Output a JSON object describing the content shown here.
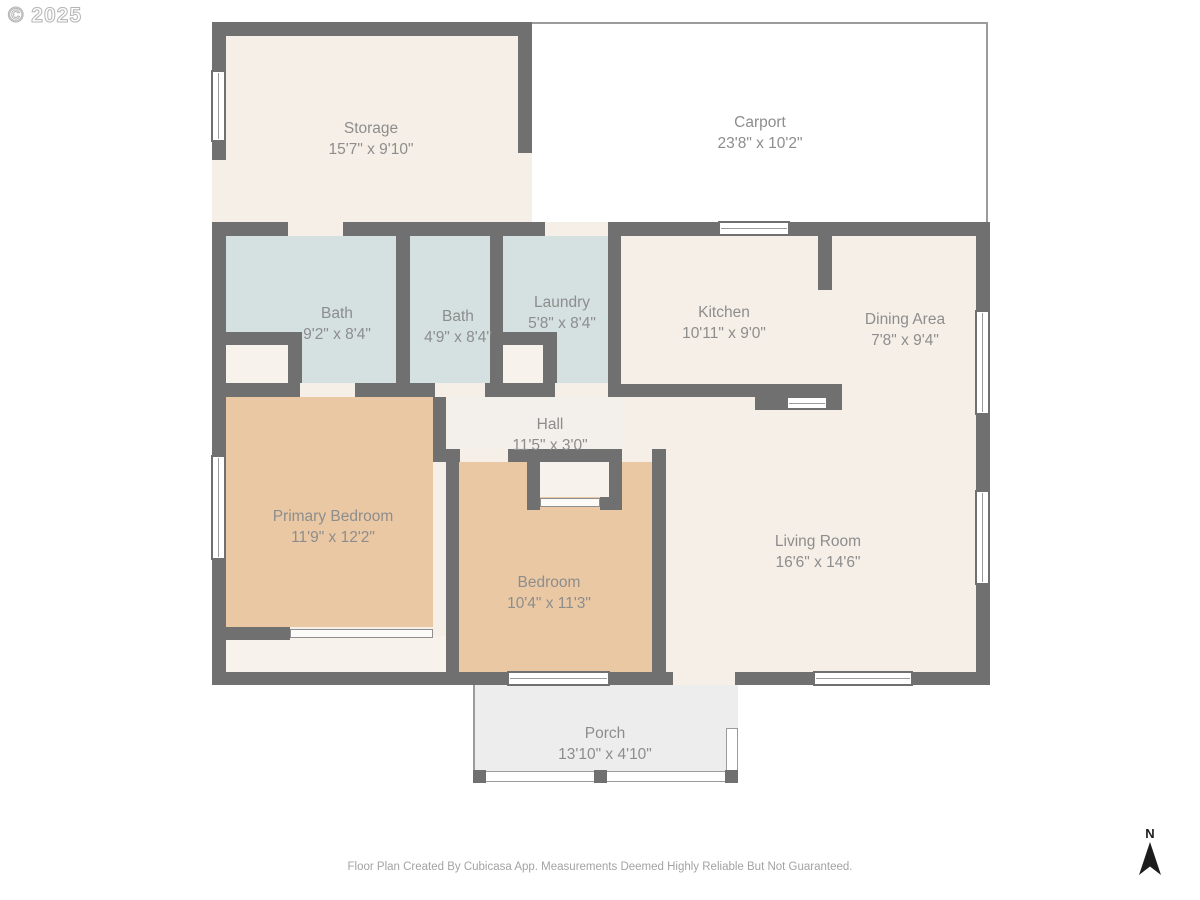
{
  "watermark": "© 2025",
  "footer": "Floor Plan Created By Cubicasa App. Measurements Deemed Highly Reliable But Not Guaranteed.",
  "compass": {
    "north_label": "N"
  },
  "colors": {
    "wall": "#707070",
    "cream": "#f6efe7",
    "blue": "#d4e1e0",
    "tan": "#ebc8a4",
    "closet": "#f7f2ec",
    "hallfill": "#f3efea",
    "porch": "#ededed",
    "outline": "#9c9c9c",
    "label": "#8d8d8d",
    "footer": "#a3a3a3",
    "winline": "#9a9a9a",
    "compass": "#1c1c1c",
    "wmline": "#b5b5b5"
  },
  "rooms": [
    {
      "id": "storage",
      "name": "Storage",
      "dims": "15'7\" x 9'10\""
    },
    {
      "id": "carport",
      "name": "Carport",
      "dims": "23'8\" x 10'2\""
    },
    {
      "id": "bath-1",
      "name": "Bath",
      "dims": "9'2\" x 8'4\""
    },
    {
      "id": "bath-2",
      "name": "Bath",
      "dims": "4'9\" x 8'4\""
    },
    {
      "id": "laundry",
      "name": "Laundry",
      "dims": "5'8\" x 8'4\""
    },
    {
      "id": "kitchen",
      "name": "Kitchen",
      "dims": "10'11\" x 9'0\""
    },
    {
      "id": "dining-area",
      "name": "Dining Area",
      "dims": "7'8\" x 9'4\""
    },
    {
      "id": "hall",
      "name": "Hall",
      "dims": "11'5\" x 3'0\""
    },
    {
      "id": "primary-bedroom",
      "name": "Primary Bedroom",
      "dims": "11'9\" x 12'2\""
    },
    {
      "id": "bedroom",
      "name": "Bedroom",
      "dims": "10'4\" x 11'3\""
    },
    {
      "id": "living-room",
      "name": "Living Room",
      "dims": "16'6\" x 14'6\""
    },
    {
      "id": "porch",
      "name": "Porch",
      "dims": "13'10\" x 4'10\""
    }
  ]
}
